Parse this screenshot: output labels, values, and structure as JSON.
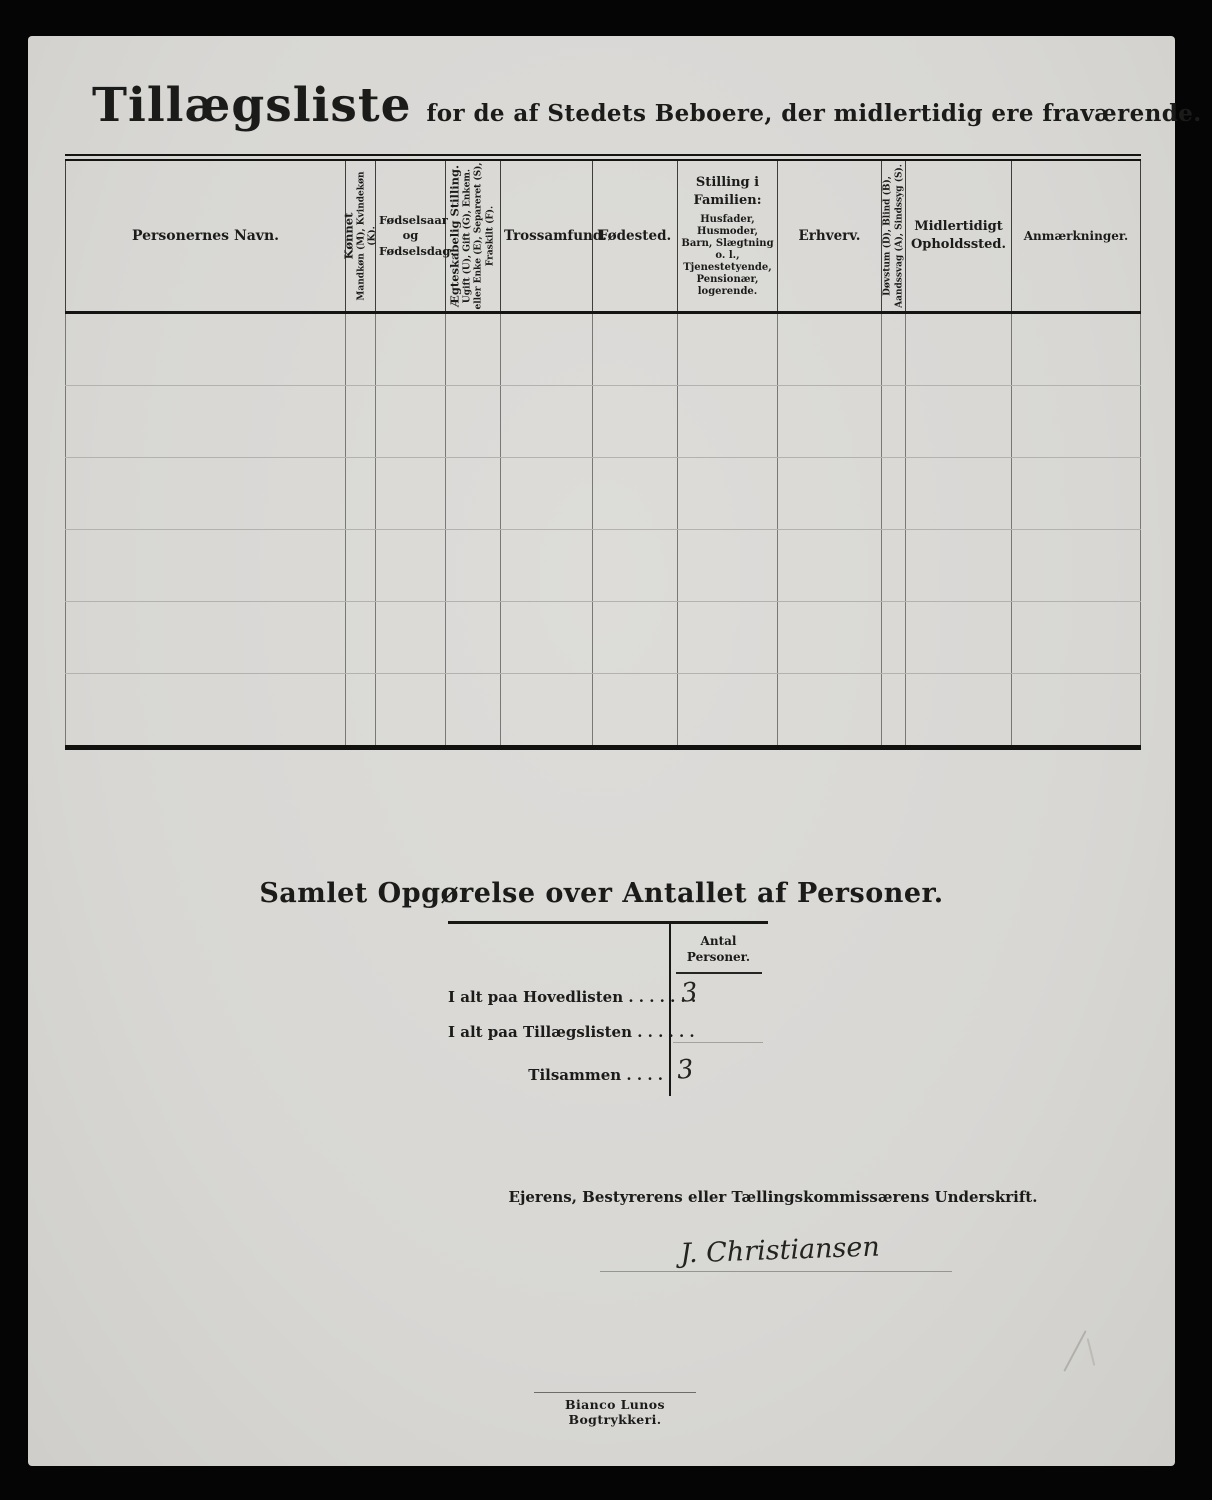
{
  "page": {
    "title": "Tillægsliste",
    "subtitle": "for de af Stedets Beboere, der midlertidig ere fraværende."
  },
  "table": {
    "row_count": 6,
    "columns": {
      "navn": {
        "label": "Personernes Navn."
      },
      "kon": {
        "label": "Kønnet",
        "sub": "Mandkøn (M), Kvindekøn (K)."
      },
      "fodselsaar": {
        "label": "Fødselsaar og Fødselsdag."
      },
      "aegteskabelig": {
        "label": "Ægteskabelig Stilling.",
        "sub": "Ugift (U), Gift (G), Enkem. eller Enke (E), Separeret (S), Fraskilt (F)."
      },
      "trossamfund": {
        "label": "Trossamfund."
      },
      "fodested": {
        "label": "Fødested."
      },
      "stilling": {
        "label": "Stilling i Familien:",
        "sub": "Husfader, Husmoder, Barn, Slægtning o. l., Tjenestetyende, Pensionær, logerende."
      },
      "erhverv": {
        "label": "Erhverv."
      },
      "dovstum": {
        "label": "Døvstum (D), Blind (B), Aandssvag (A), Sindssyg (S)."
      },
      "opholdssted": {
        "label": "Midlertidigt Opholdssted."
      },
      "anmaerkninger": {
        "label": "Anmærkninger."
      }
    }
  },
  "summary": {
    "heading": "Samlet Opgørelse over Antallet af Personer.",
    "column_header": "Antal Personer.",
    "rows": [
      {
        "label": "I alt paa Hovedlisten . . . . . . .",
        "value": "3"
      },
      {
        "label": "I alt paa Tillægslisten  . . . . . .",
        "value": ""
      },
      {
        "label": "Tilsammen . . . .",
        "value": "3"
      }
    ]
  },
  "signature": {
    "caption": "Ejerens, Bestyrerens eller Tællingskommissærens Underskrift.",
    "name": "J. Christiansen"
  },
  "footer": {
    "printer": "Bianco Lunos Bogtrykkeri."
  }
}
